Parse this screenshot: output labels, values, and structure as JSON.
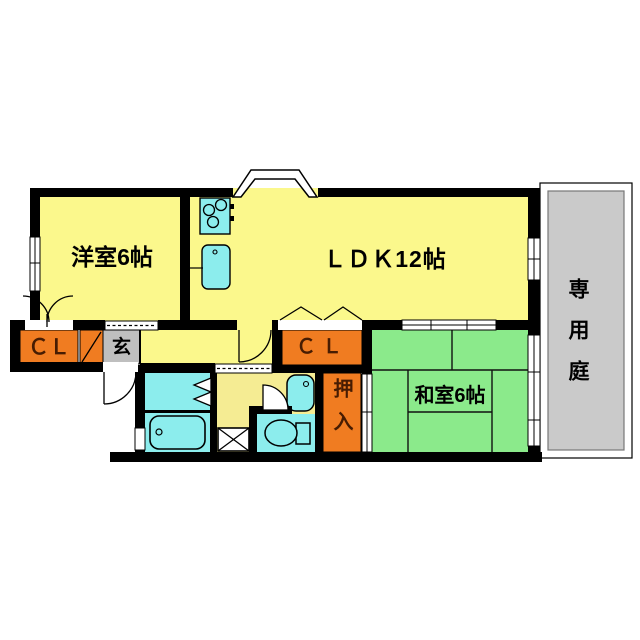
{
  "floorplan": {
    "type": "japanese-apartment-floor-plan",
    "rooms": {
      "western_room": {
        "label": "洋室6帖",
        "meaning": "western-style room 6 tatami"
      },
      "ldk": {
        "label": "ＬＤＫ12帖",
        "meaning": "living-dining-kitchen 12 tatami"
      },
      "japanese_room": {
        "label": "和室6帖",
        "meaning": "japanese-style tatami room 6 tatami"
      },
      "closet_left": {
        "label": "ＣＬ"
      },
      "closet_middle": {
        "label": "ＣＬ"
      },
      "entrance": {
        "label": "玄"
      },
      "oshiire": {
        "label": "押入"
      },
      "private_garden": {
        "label": "専用庭"
      }
    },
    "fixtures": [
      "kitchen-stove",
      "kitchen-sink",
      "bathtub",
      "washbasin",
      "toilet",
      "washing-machine-pan",
      "bay-window",
      "sliding-doors",
      "hinged-doors",
      "bifold-doors"
    ],
    "colors": {
      "room_yellow": "#FBF88C",
      "powder_yellow": "#F5EC93",
      "tatami_green": "#8BEA8B",
      "closet_orange": "#F07C21",
      "fixture_cyan": "#8CEDED",
      "entrance_gray": "#BFBFBF",
      "garden_gray": "#CACACA",
      "wall_black": "#000000",
      "label_on_orange": "#471c02"
    }
  }
}
